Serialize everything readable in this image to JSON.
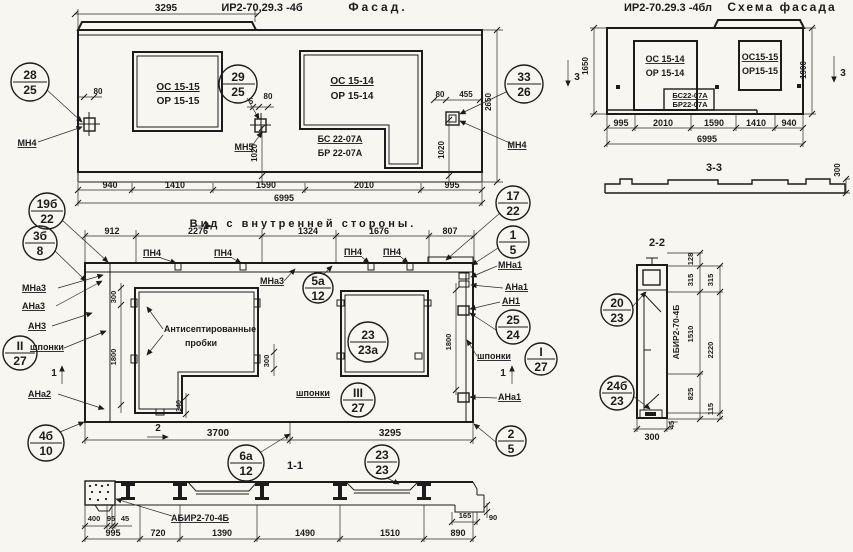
{
  "sheet": {
    "drawing_code": "ИР2-70.29.3",
    "views": [
      "Фасад",
      "Схема фасада",
      "Вид с внутренней стороны",
      "1-1",
      "2-2",
      "3-3"
    ]
  },
  "views": [
    {
      "name": "facade",
      "labels": [
        {
          "t": "3295",
          "x": 166,
          "y": 11,
          "fs": 10
        },
        {
          "t": "ИР2-70.29.3 -4б",
          "x": 262,
          "y": 11,
          "fs": 11
        },
        {
          "t": "Фасад.",
          "x": 378,
          "y": 11,
          "fs": 12,
          "sp": 3
        },
        {
          "t": "ОС 15-15",
          "x": 178,
          "y": 90,
          "fs": 10,
          "u": 1
        },
        {
          "t": "ОР 15-15",
          "x": 178,
          "y": 104,
          "fs": 10
        },
        {
          "t": "ОС 15-14",
          "x": 352,
          "y": 84,
          "fs": 10,
          "u": 1
        },
        {
          "t": "ОР 15-14",
          "x": 352,
          "y": 99,
          "fs": 10
        },
        {
          "t": "БС 22-07А",
          "x": 340,
          "y": 142,
          "fs": 9,
          "u": 1
        },
        {
          "t": "БР 22-07А",
          "x": 340,
          "y": 156,
          "fs": 9
        },
        {
          "t": "80",
          "x": 98,
          "y": 94,
          "fs": 8
        },
        {
          "t": "5",
          "x": 251,
          "y": 104,
          "fs": 8
        },
        {
          "t": "80",
          "x": 268,
          "y": 99,
          "fs": 8
        },
        {
          "t": "80",
          "x": 440,
          "y": 97,
          "fs": 8
        },
        {
          "t": "455",
          "x": 466,
          "y": 97,
          "fs": 8
        },
        {
          "t": "МН4",
          "x": 27,
          "y": 146,
          "fs": 9,
          "u": 1
        },
        {
          "t": "МН5",
          "x": 244,
          "y": 150,
          "fs": 9,
          "u": 1
        },
        {
          "t": "МН4",
          "x": 517,
          "y": 148,
          "fs": 9,
          "u": 1
        },
        {
          "t": "1020",
          "x": 257,
          "y": 153,
          "fs": 8,
          "r": -90
        },
        {
          "t": "1020",
          "x": 444,
          "y": 150,
          "fs": 8,
          "r": -90
        },
        {
          "t": "2650",
          "x": 491,
          "y": 102,
          "fs": 8,
          "r": -90
        },
        {
          "t": "940",
          "x": 110,
          "y": 188,
          "fs": 9
        },
        {
          "t": "1410",
          "x": 175,
          "y": 188,
          "fs": 9
        },
        {
          "t": "1590",
          "x": 266,
          "y": 188,
          "fs": 9
        },
        {
          "t": "2010",
          "x": 364,
          "y": 188,
          "fs": 9
        },
        {
          "t": "995",
          "x": 452,
          "y": 188,
          "fs": 9
        },
        {
          "t": "6995",
          "x": 284,
          "y": 201,
          "fs": 9
        }
      ]
    },
    {
      "name": "facade-scheme",
      "labels": [
        {
          "t": "ИР2-70.29.3 -4бл",
          "x": 668,
          "y": 11,
          "fs": 11
        },
        {
          "t": "Схема фасада",
          "x": 782,
          "y": 11,
          "fs": 12,
          "sp": 2
        },
        {
          "t": "ОС 15-14",
          "x": 665,
          "y": 62,
          "fs": 9,
          "u": 1
        },
        {
          "t": "ОР 15-14",
          "x": 665,
          "y": 76,
          "fs": 9
        },
        {
          "t": "БС22-07А",
          "x": 690,
          "y": 98,
          "fs": 7.5,
          "u": 1
        },
        {
          "t": "БР22-07А",
          "x": 690,
          "y": 107,
          "fs": 7.5
        },
        {
          "t": "ОС15-15",
          "x": 760,
          "y": 60,
          "fs": 9,
          "u": 1
        },
        {
          "t": "ОР15-15",
          "x": 760,
          "y": 74,
          "fs": 9
        },
        {
          "t": "1650",
          "x": 588,
          "y": 66,
          "fs": 8,
          "r": -90
        },
        {
          "t": "1900",
          "x": 806,
          "y": 70,
          "fs": 8,
          "r": -90
        },
        {
          "t": "995",
          "x": 621,
          "y": 126,
          "fs": 9
        },
        {
          "t": "2010",
          "x": 663,
          "y": 126,
          "fs": 9
        },
        {
          "t": "1590",
          "x": 714,
          "y": 126,
          "fs": 9
        },
        {
          "t": "1410",
          "x": 756,
          "y": 126,
          "fs": 9
        },
        {
          "t": "940",
          "x": 789,
          "y": 126,
          "fs": 9
        },
        {
          "t": "6995",
          "x": 707,
          "y": 142,
          "fs": 9
        },
        {
          "t": "3",
          "x": 577,
          "y": 80,
          "fs": 10
        },
        {
          "t": "3",
          "x": 843,
          "y": 76,
          "fs": 10
        }
      ]
    },
    {
      "name": "section-3-3",
      "labels": [
        {
          "t": "3-3",
          "x": 714,
          "y": 171,
          "fs": 11
        },
        {
          "t": "300",
          "x": 840,
          "y": 170,
          "fs": 8,
          "r": -90
        }
      ]
    },
    {
      "name": "section-2-2",
      "labels": [
        {
          "t": "2-2",
          "x": 657,
          "y": 246,
          "fs": 11
        },
        {
          "t": "128",
          "x": 693,
          "y": 259,
          "fs": 7.5,
          "r": -90
        },
        {
          "t": "315",
          "x": 693,
          "y": 280,
          "fs": 7.5,
          "r": -90
        },
        {
          "t": "315",
          "x": 713,
          "y": 280,
          "fs": 7.5,
          "r": -90
        },
        {
          "t": "1510",
          "x": 693,
          "y": 334,
          "fs": 7.5,
          "r": -90
        },
        {
          "t": "2220",
          "x": 713,
          "y": 350,
          "fs": 7.5,
          "r": -90
        },
        {
          "t": "825",
          "x": 693,
          "y": 394,
          "fs": 7.5,
          "r": -90
        },
        {
          "t": "115",
          "x": 713,
          "y": 409,
          "fs": 7.5,
          "r": -90
        },
        {
          "t": "45",
          "x": 674,
          "y": 425,
          "fs": 7.5,
          "r": -90
        },
        {
          "t": "300",
          "x": 652,
          "y": 440,
          "fs": 9
        },
        {
          "t": "АБИР2-70-4Б",
          "x": 679,
          "y": 332,
          "fs": 8.5,
          "r": -90
        }
      ]
    },
    {
      "name": "inner-view",
      "labels": [
        {
          "t": "Вид с внутренней стороны.",
          "x": 303,
          "y": 227,
          "fs": 11,
          "sp": 3
        },
        {
          "t": "912",
          "x": 112,
          "y": 234,
          "fs": 9
        },
        {
          "t": "2276",
          "x": 198,
          "y": 234,
          "fs": 9
        },
        {
          "t": "1324",
          "x": 308,
          "y": 234,
          "fs": 9
        },
        {
          "t": "1676",
          "x": 379,
          "y": 234,
          "fs": 9
        },
        {
          "t": "807",
          "x": 450,
          "y": 234,
          "fs": 9
        },
        {
          "t": "2",
          "x": 206,
          "y": 229,
          "fs": 10
        },
        {
          "t": "ПН4",
          "x": 152,
          "y": 256,
          "fs": 9,
          "u": 1
        },
        {
          "t": "ПН4",
          "x": 223,
          "y": 256,
          "fs": 9,
          "u": 1
        },
        {
          "t": "ПН4",
          "x": 353,
          "y": 255,
          "fs": 9,
          "u": 1
        },
        {
          "t": "ПН4",
          "x": 392,
          "y": 255,
          "fs": 9,
          "u": 1
        },
        {
          "t": "МНа3",
          "x": 22,
          "y": 291,
          "fs": 9,
          "a": "s",
          "u": 1
        },
        {
          "t": "АНа3",
          "x": 22,
          "y": 309,
          "fs": 9,
          "a": "s",
          "u": 1
        },
        {
          "t": "АН3",
          "x": 28,
          "y": 329,
          "fs": 9,
          "a": "s",
          "u": 1
        },
        {
          "t": "шпонки",
          "x": 30,
          "y": 350,
          "fs": 9,
          "a": "s",
          "u": 1
        },
        {
          "t": "АНа2",
          "x": 28,
          "y": 397,
          "fs": 9,
          "a": "s",
          "u": 1
        },
        {
          "t": "МНа3",
          "x": 260,
          "y": 284,
          "fs": 9,
          "a": "s",
          "u": 1
        },
        {
          "t": "Антисептированные",
          "x": 210,
          "y": 332,
          "fs": 9
        },
        {
          "t": "пробки",
          "x": 201,
          "y": 346,
          "fs": 9
        },
        {
          "t": "300",
          "x": 116,
          "y": 297,
          "fs": 7.5,
          "r": -90
        },
        {
          "t": "1800",
          "x": 116,
          "y": 357,
          "fs": 7.5,
          "r": -90
        },
        {
          "t": "300",
          "x": 269,
          "y": 361,
          "fs": 7.5,
          "r": -90
        },
        {
          "t": "340",
          "x": 181,
          "y": 406,
          "fs": 7,
          "r": -90
        },
        {
          "t": "1800",
          "x": 451,
          "y": 342,
          "fs": 7.5,
          "r": -90
        },
        {
          "t": "1",
          "x": 54,
          "y": 376,
          "fs": 10
        },
        {
          "t": "1",
          "x": 503,
          "y": 376,
          "fs": 10
        },
        {
          "t": "шпонки",
          "x": 296,
          "y": 396,
          "fs": 9,
          "a": "s",
          "u": 1
        },
        {
          "t": "шпонки",
          "x": 477,
          "y": 359,
          "fs": 9,
          "a": "s",
          "u": 1
        },
        {
          "t": "МНа1",
          "x": 498,
          "y": 268,
          "fs": 9,
          "a": "s",
          "u": 1
        },
        {
          "t": "АНа1",
          "x": 505,
          "y": 290,
          "fs": 9,
          "a": "s",
          "u": 1
        },
        {
          "t": "АН1",
          "x": 502,
          "y": 304,
          "fs": 9,
          "a": "s",
          "u": 1
        },
        {
          "t": "АНа1",
          "x": 498,
          "y": 400,
          "fs": 9,
          "a": "s",
          "u": 1
        },
        {
          "t": "2",
          "x": 158,
          "y": 431,
          "fs": 10
        },
        {
          "t": "3700",
          "x": 218,
          "y": 436,
          "fs": 10
        },
        {
          "t": "3295",
          "x": 390,
          "y": 436,
          "fs": 10
        },
        {
          "t": "1-1",
          "x": 295,
          "y": 469,
          "fs": 11
        }
      ]
    },
    {
      "name": "section-1-1",
      "labels": [
        {
          "t": "400",
          "x": 94,
          "y": 521,
          "fs": 7.5
        },
        {
          "t": "95",
          "x": 111,
          "y": 521,
          "fs": 7.5
        },
        {
          "t": "45",
          "x": 125,
          "y": 521,
          "fs": 7.5
        },
        {
          "t": "АБИР2-70-4Б",
          "x": 200,
          "y": 521,
          "fs": 9,
          "u": 1
        },
        {
          "t": "165",
          "x": 465,
          "y": 518,
          "fs": 7.5
        },
        {
          "t": "90",
          "x": 493,
          "y": 520,
          "fs": 7.5
        },
        {
          "t": "995",
          "x": 113,
          "y": 536,
          "fs": 9
        },
        {
          "t": "720",
          "x": 158,
          "y": 536,
          "fs": 9
        },
        {
          "t": "1390",
          "x": 222,
          "y": 536,
          "fs": 9
        },
        {
          "t": "1490",
          "x": 305,
          "y": 536,
          "fs": 9
        },
        {
          "t": "1510",
          "x": 390,
          "y": 536,
          "fs": 9
        },
        {
          "t": "890",
          "x": 458,
          "y": 536,
          "fs": 9
        }
      ]
    }
  ],
  "markers": [
    {
      "x": 30,
      "y": 82,
      "r": 19,
      "top": "28",
      "bot": "25"
    },
    {
      "x": 238,
      "y": 84,
      "r": 19,
      "top": "29",
      "bot": "25"
    },
    {
      "x": 524,
      "y": 84,
      "r": 19,
      "top": "33",
      "bot": "26"
    },
    {
      "x": 47,
      "y": 211,
      "r": 18,
      "top": "19б",
      "bot": "22"
    },
    {
      "x": 40,
      "y": 243,
      "r": 17,
      "top": "3б",
      "bot": "8"
    },
    {
      "x": 513,
      "y": 203,
      "r": 17,
      "top": "17",
      "bot": "22"
    },
    {
      "x": 513,
      "y": 242,
      "r": 16,
      "top": "1",
      "bot": "5"
    },
    {
      "x": 318,
      "y": 288,
      "r": 15,
      "top": "5а",
      "bot": "12"
    },
    {
      "x": 368,
      "y": 342,
      "r": 20,
      "top": "23",
      "bot": "23а"
    },
    {
      "x": 513,
      "y": 327,
      "r": 17,
      "top": "25",
      "bot": "24"
    },
    {
      "x": 541,
      "y": 359,
      "r": 16,
      "top": "I",
      "bot": "27"
    },
    {
      "x": 20,
      "y": 353,
      "r": 17,
      "top": "II",
      "bot": "27"
    },
    {
      "x": 358,
      "y": 400,
      "r": 17,
      "top": "III",
      "bot": "27"
    },
    {
      "x": 46,
      "y": 443,
      "r": 18,
      "top": "4б",
      "bot": "10"
    },
    {
      "x": 246,
      "y": 463,
      "r": 18,
      "top": "6а",
      "bot": "12"
    },
    {
      "x": 382,
      "y": 462,
      "r": 17,
      "top": "23",
      "bot": "23"
    },
    {
      "x": 511,
      "y": 441,
      "r": 15,
      "top": "2",
      "bot": "5"
    },
    {
      "x": 617,
      "y": 310,
      "r": 16,
      "top": "20",
      "bot": "23"
    },
    {
      "x": 617,
      "y": 393,
      "r": 17,
      "top": "24б",
      "bot": "23"
    }
  ]
}
